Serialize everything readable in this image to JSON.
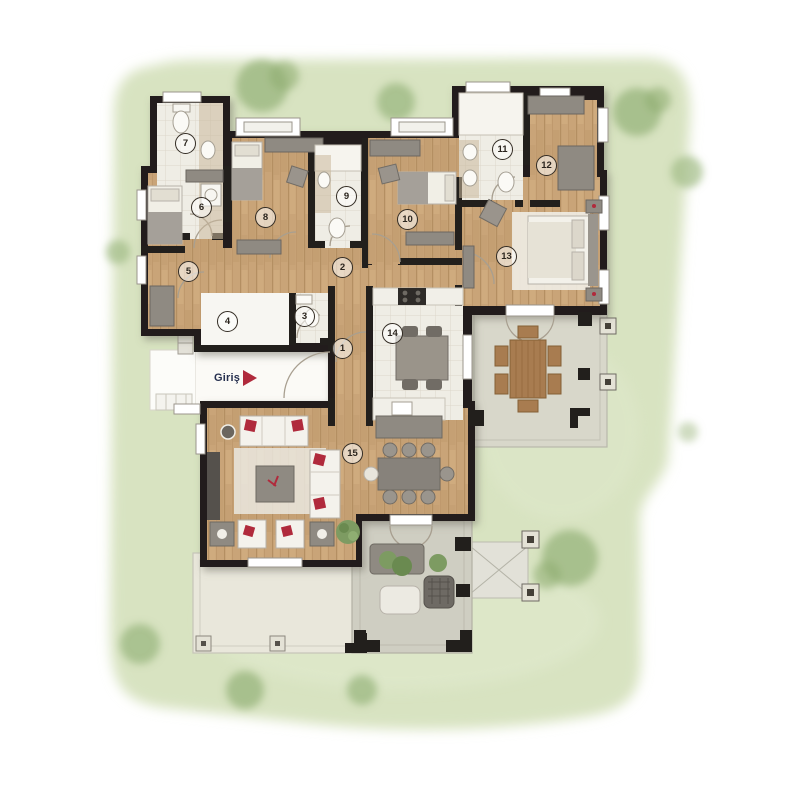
{
  "plan": {
    "entrance_label": "Giriş",
    "rooms": [
      {
        "number": "1"
      },
      {
        "number": "2"
      },
      {
        "number": "3"
      },
      {
        "number": "4"
      },
      {
        "number": "5"
      },
      {
        "number": "6"
      },
      {
        "number": "7"
      },
      {
        "number": "8"
      },
      {
        "number": "9"
      },
      {
        "number": "10"
      },
      {
        "number": "11"
      },
      {
        "number": "12"
      },
      {
        "number": "13"
      },
      {
        "number": "14"
      },
      {
        "number": "15"
      }
    ]
  },
  "colors": {
    "lawn": "#d8e3c1",
    "tree": "#9fba84",
    "wall": "#221f1c",
    "wood_floor": "#c9a478",
    "tile_floor": "#efede5",
    "terrace_floor": "#d8d7ca",
    "pergola_floor": "#cfcec2",
    "patio_floor": "#e9e7db",
    "furniture_gray": "#8f8a82",
    "furniture_white": "#f4f2ec",
    "wood_furniture": "#a87c50",
    "accent_red": "#b02a3c",
    "entrance_text": "#26304f"
  }
}
